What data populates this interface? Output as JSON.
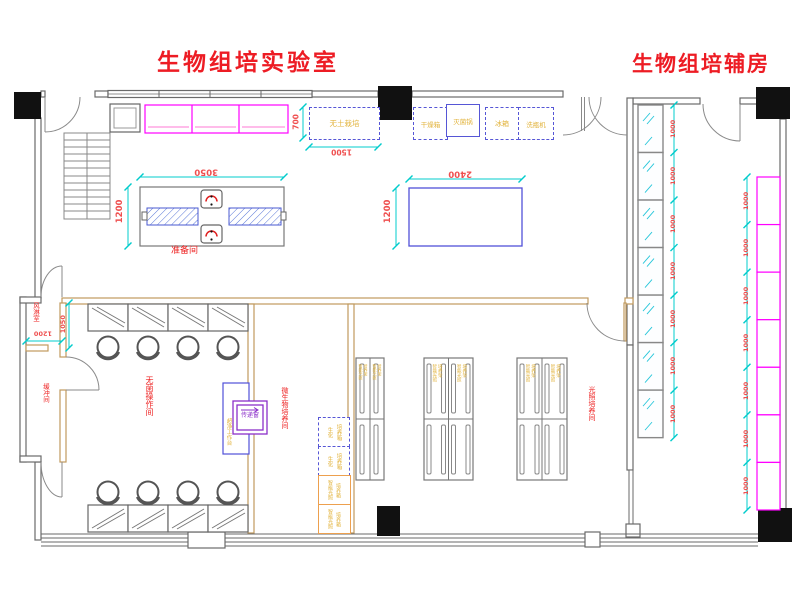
{
  "titles": {
    "main": "生物组培实验室",
    "aux": "生物组培辅房"
  },
  "rooms": {
    "prep": "准备间",
    "sterile_op": "无菌操作间",
    "air_shower": "风淋室",
    "buffer": "缓冲间",
    "microbio": "微生物培养间",
    "light_culture": "光照培养间"
  },
  "equipment": {
    "soilless": "无土栽培",
    "drying_oven": "干燥箱",
    "sterilizer": "灭菌锅",
    "fridge": "冰箱",
    "bottle_washer": "洗瓶机",
    "pass_window": "传递窗",
    "clean_bench": "超净工作台",
    "biochem_incubator_lines": [
      "生化",
      "培养箱"
    ],
    "light_incubator_lines": [
      "智能光照",
      "培养箱"
    ],
    "light_rack_lines": [
      "智能光照",
      "培养架"
    ]
  },
  "dims": {
    "soilless_h": "700",
    "soilless_w": "1500",
    "prep_table_w": "3050",
    "prep_table_h": "1200",
    "center_table_w": "2400",
    "center_table_h": "1200",
    "air_shower_h": "1050",
    "air_shower_w": "1200",
    "unit": "1000"
  },
  "aux": {
    "glass_cells": 7,
    "bench_cells": 7
  },
  "colors": {
    "title_red": "#ed1c24",
    "label_red": "#ee2222",
    "dim_red": "#ef4f4f",
    "dim_cyan": "#00cccc",
    "equip_yellow": "#e2b33c",
    "bench_magenta": "#ff00ff",
    "table_blue": "#5050d8",
    "pass_purple": "#8b2fc9",
    "incubator_orange": "#eda04e",
    "wall_tan": "#c09a5e",
    "wall_gray": "#6a6a6a"
  }
}
